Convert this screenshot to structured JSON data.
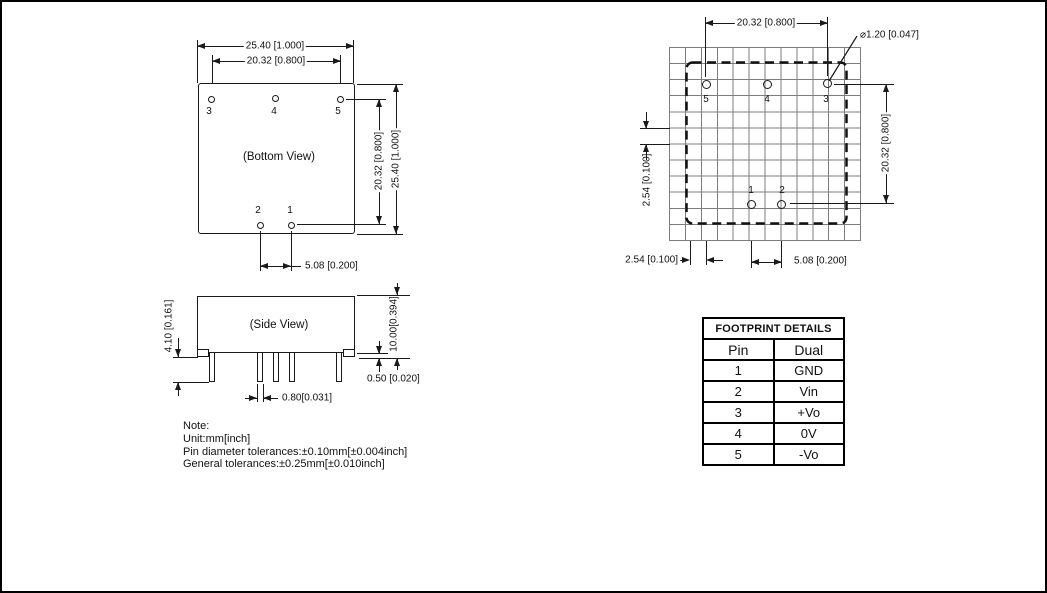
{
  "colors": {
    "line": "#1a1a1a",
    "grid": "#7d7d7d"
  },
  "bottom_view": {
    "label": "(Bottom View)",
    "dim_width_outer": "25.40 [1.000]",
    "dim_width_pins": "20.32 [0.800]",
    "dim_height_pins": "20.32 [0.800]",
    "dim_height_outer": "25.40 [1.000]",
    "dim_pin_pitch": "5.08 [0.200]",
    "pin_labels": {
      "p3": "3",
      "p4": "4",
      "p5": "5",
      "p2": "2",
      "p1": "1"
    }
  },
  "side_view": {
    "label": "(Side View)",
    "dim_pin_length": "4.10 [0.161]",
    "dim_body_height": "10.00[0.394]",
    "dim_standoff": "0.50 [0.020]",
    "dim_pin_width": "0.80[0.031]"
  },
  "footprint": {
    "dim_width_pins": "20.32 [0.800]",
    "dim_hole_diameter": "⌀1.20 [0.047]",
    "dim_grid_pitch_v": "2.54 [0.100]",
    "dim_height_pins": "20.32 [0.800]",
    "dim_grid_pitch_h": "2.54 [0.100]",
    "dim_pin_pitch": "5.08 [0.200]",
    "pin_labels": {
      "p5": "5",
      "p4": "4",
      "p3": "3",
      "p1": "1",
      "p2": "2"
    }
  },
  "table": {
    "title": "FOOTPRINT DETAILS",
    "columns": [
      "Pin",
      "Dual"
    ],
    "rows": [
      [
        "1",
        "GND"
      ],
      [
        "2",
        "Vin"
      ],
      [
        "3",
        "+Vo"
      ],
      [
        "4",
        "0V"
      ],
      [
        "5",
        "-Vo"
      ]
    ]
  },
  "note": {
    "line1": "Note:",
    "line2": "Unit:mm[inch]",
    "line3": "Pin diameter tolerances:±0.10mm[±0.004inch]",
    "line4": "General tolerances:±0.25mm[±0.010inch]"
  }
}
